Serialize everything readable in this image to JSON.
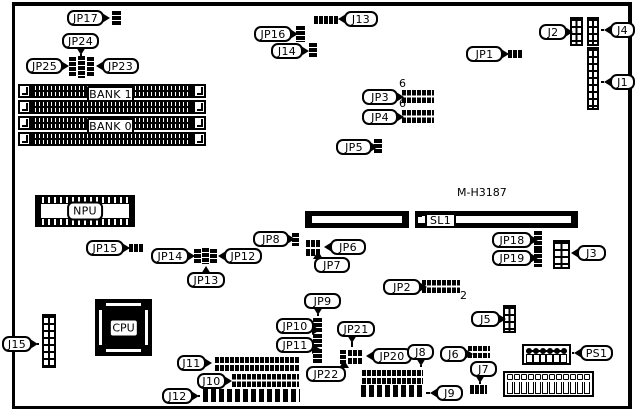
{
  "page": {
    "background": "#ffffff",
    "line_color": "#000000",
    "board_model": "M-H3187"
  },
  "components": [
    {
      "name": "board-outline",
      "type": "frame",
      "x": 12,
      "y": 2,
      "w": 620,
      "h": 407
    },
    {
      "name": "callout-jp17",
      "type": "callout",
      "label": "JP17",
      "x": 67,
      "y": 10,
      "w": 37,
      "h": 16,
      "dir": "right"
    },
    {
      "name": "jumper-jp17",
      "type": "jv",
      "x": 112,
      "y": 11,
      "w": 9,
      "h": 15
    },
    {
      "name": "callout-jp24",
      "type": "callout",
      "label": "JP24",
      "x": 62,
      "y": 33,
      "w": 37,
      "h": 16,
      "dir": "down",
      "leader": 2
    },
    {
      "name": "callout-jp25",
      "type": "callout",
      "label": "JP25",
      "x": 26,
      "y": 58,
      "w": 37,
      "h": 16,
      "dir": "right"
    },
    {
      "name": "callout-jp23",
      "type": "callout",
      "label": "JP23",
      "x": 102,
      "y": 58,
      "w": 37,
      "h": 16,
      "dir": "left"
    },
    {
      "name": "jumper-jp25",
      "type": "jv",
      "x": 69,
      "y": 57,
      "w": 7,
      "h": 20
    },
    {
      "name": "jumper-jp24",
      "type": "jv",
      "x": 78,
      "y": 56,
      "w": 7,
      "h": 22
    },
    {
      "name": "jumper-jp23",
      "type": "jv",
      "x": 87,
      "y": 57,
      "w": 7,
      "h": 20
    },
    {
      "name": "simm-clip-left-1",
      "type": "clip",
      "x": 18,
      "y": 84,
      "w": 13,
      "h": 14
    },
    {
      "name": "simm-clip-left-2",
      "type": "clip",
      "x": 18,
      "y": 100,
      "w": 13,
      "h": 14
    },
    {
      "name": "simm-clip-left-3",
      "type": "clip",
      "x": 18,
      "y": 116,
      "w": 13,
      "h": 14
    },
    {
      "name": "simm-clip-left-4",
      "type": "clip",
      "x": 18,
      "y": 132,
      "w": 13,
      "h": 14
    },
    {
      "name": "simm-socket-1",
      "type": "simm",
      "x": 31,
      "y": 84,
      "w": 162,
      "h": 14
    },
    {
      "name": "simm-socket-2",
      "type": "simm",
      "x": 31,
      "y": 100,
      "w": 162,
      "h": 14
    },
    {
      "name": "simm-socket-3",
      "type": "simm",
      "x": 31,
      "y": 116,
      "w": 162,
      "h": 14
    },
    {
      "name": "simm-socket-4",
      "type": "simm",
      "x": 31,
      "y": 132,
      "w": 162,
      "h": 14
    },
    {
      "name": "simm-clip-right-1",
      "type": "clip",
      "x": 193,
      "y": 84,
      "w": 13,
      "h": 14
    },
    {
      "name": "simm-clip-right-2",
      "type": "clip",
      "x": 193,
      "y": 100,
      "w": 13,
      "h": 14
    },
    {
      "name": "simm-clip-right-3",
      "type": "clip",
      "x": 193,
      "y": 116,
      "w": 13,
      "h": 14
    },
    {
      "name": "simm-clip-right-4",
      "type": "clip",
      "x": 193,
      "y": 132,
      "w": 13,
      "h": 14
    },
    {
      "name": "label-bank1",
      "type": "callout",
      "label": "BANK 1",
      "x": 87,
      "y": 86,
      "w": 47,
      "h": 16,
      "variant": "square"
    },
    {
      "name": "label-bank0",
      "type": "callout",
      "label": "BANK 0",
      "x": 87,
      "y": 118,
      "w": 47,
      "h": 16,
      "variant": "square"
    },
    {
      "name": "callout-jp16",
      "type": "callout",
      "label": "JP16",
      "x": 254,
      "y": 26,
      "w": 38,
      "h": 16,
      "dir": "right"
    },
    {
      "name": "jumper-jp16",
      "type": "jv",
      "x": 296,
      "y": 26,
      "w": 9,
      "h": 16
    },
    {
      "name": "callout-j13",
      "type": "callout",
      "label": "J13",
      "x": 344,
      "y": 11,
      "w": 34,
      "h": 16,
      "dir": "left"
    },
    {
      "name": "connector-j13",
      "type": "jh",
      "x": 314,
      "y": 16,
      "w": 25,
      "h": 8
    },
    {
      "name": "callout-j14",
      "type": "callout",
      "label": "J14",
      "x": 271,
      "y": 43,
      "w": 32,
      "h": 16,
      "dir": "right"
    },
    {
      "name": "jumper-j14",
      "type": "jv",
      "x": 309,
      "y": 43,
      "w": 8,
      "h": 15
    },
    {
      "name": "callout-j2",
      "type": "callout",
      "label": "J2",
      "x": 539,
      "y": 24,
      "w": 28,
      "h": 16,
      "dir": "right"
    },
    {
      "name": "connector-j2",
      "type": "grid",
      "x": 570,
      "y": 17,
      "w": 13,
      "h": 29
    },
    {
      "name": "callout-j4",
      "type": "callout",
      "label": "J4",
      "x": 610,
      "y": 22,
      "w": 25,
      "h": 16,
      "dir": "left",
      "leader": 3
    },
    {
      "name": "connector-j4",
      "type": "grid",
      "x": 587,
      "y": 17,
      "w": 12,
      "h": 29
    },
    {
      "name": "callout-j1",
      "type": "callout",
      "label": "J1",
      "x": 610,
      "y": 74,
      "w": 25,
      "h": 16,
      "dir": "left",
      "leader": 3
    },
    {
      "name": "connector-j1",
      "type": "grid",
      "x": 587,
      "y": 47,
      "w": 12,
      "h": 63
    },
    {
      "name": "callout-jp1",
      "type": "callout",
      "label": "JP1",
      "x": 466,
      "y": 46,
      "w": 37,
      "h": 16,
      "dir": "right"
    },
    {
      "name": "jumper-jp1",
      "type": "jh",
      "x": 508,
      "y": 50,
      "w": 15,
      "h": 8
    },
    {
      "name": "callout-jp3",
      "type": "callout",
      "label": "JP3",
      "x": 362,
      "y": 89,
      "w": 36,
      "h": 16,
      "dir": "right"
    },
    {
      "name": "block-jp3",
      "type": "bg",
      "x": 402,
      "y": 90,
      "w": 32,
      "h": 13
    },
    {
      "name": "pin6-jp3",
      "type": "txt",
      "label": "6",
      "x": 399,
      "y": 78,
      "w": 10,
      "h": 12
    },
    {
      "name": "callout-jp4",
      "type": "callout",
      "label": "JP4",
      "x": 362,
      "y": 109,
      "w": 36,
      "h": 16,
      "dir": "right"
    },
    {
      "name": "block-jp4",
      "type": "bg",
      "x": 402,
      "y": 110,
      "w": 32,
      "h": 13
    },
    {
      "name": "pin6-jp4",
      "type": "txt",
      "label": "6",
      "x": 399,
      "y": 98,
      "w": 10,
      "h": 12
    },
    {
      "name": "callout-jp5",
      "type": "callout",
      "label": "JP5",
      "x": 336,
      "y": 139,
      "w": 36,
      "h": 16,
      "dir": "right"
    },
    {
      "name": "jumper-jp5",
      "type": "jv",
      "x": 374,
      "y": 139,
      "w": 8,
      "h": 15
    },
    {
      "name": "npu-socket",
      "type": "npu",
      "label": "NPU",
      "x": 35,
      "y": 195,
      "w": 100,
      "h": 32
    },
    {
      "name": "board-model-text",
      "type": "txt",
      "label": "M-H3187",
      "x": 457,
      "y": 187,
      "w": 62,
      "h": 13
    },
    {
      "name": "slot-a",
      "type": "slot",
      "x": 305,
      "y": 211,
      "w": 104,
      "h": 17
    },
    {
      "name": "slot-b",
      "type": "slot",
      "x": 415,
      "y": 211,
      "w": 163,
      "h": 17
    },
    {
      "name": "sl1-pin",
      "type": "sq",
      "x": 418,
      "y": 217,
      "w": 6,
      "h": 6
    },
    {
      "name": "label-sl1",
      "type": "callout",
      "label": "SL1",
      "x": 425,
      "y": 213,
      "w": 31,
      "h": 15,
      "variant": "square"
    },
    {
      "name": "callout-jp15",
      "type": "callout",
      "label": "JP15",
      "x": 86,
      "y": 240,
      "w": 38,
      "h": 16,
      "dir": "right"
    },
    {
      "name": "jumper-jp15",
      "type": "jh",
      "x": 129,
      "y": 244,
      "w": 14,
      "h": 8
    },
    {
      "name": "callout-jp14",
      "type": "callout",
      "label": "JP14",
      "x": 151,
      "y": 248,
      "w": 38,
      "h": 16,
      "dir": "right"
    },
    {
      "name": "callout-jp12",
      "type": "callout",
      "label": "JP12",
      "x": 224,
      "y": 248,
      "w": 38,
      "h": 16,
      "dir": "left"
    },
    {
      "name": "callout-jp13",
      "type": "callout",
      "label": "JP13",
      "x": 187,
      "y": 272,
      "w": 38,
      "h": 16,
      "dir": "up"
    },
    {
      "name": "jumper-jp14",
      "type": "jv",
      "x": 194,
      "y": 249,
      "w": 7,
      "h": 14
    },
    {
      "name": "jumper-jp13",
      "type": "jv",
      "x": 202,
      "y": 248,
      "w": 7,
      "h": 16
    },
    {
      "name": "jumper-jp12",
      "type": "jv",
      "x": 210,
      "y": 249,
      "w": 7,
      "h": 14
    },
    {
      "name": "callout-jp8",
      "type": "callout",
      "label": "JP8",
      "x": 253,
      "y": 231,
      "w": 36,
      "h": 16,
      "dir": "right"
    },
    {
      "name": "jumper-jp8",
      "type": "jv",
      "x": 292,
      "y": 233,
      "w": 7,
      "h": 13
    },
    {
      "name": "callout-jp6",
      "type": "callout",
      "label": "JP6",
      "x": 330,
      "y": 239,
      "w": 36,
      "h": 16,
      "dir": "left"
    },
    {
      "name": "block-jp6-jp7",
      "type": "bg",
      "x": 306,
      "y": 240,
      "w": 14,
      "h": 16
    },
    {
      "name": "callout-jp7",
      "type": "callout",
      "label": "JP7",
      "x": 314,
      "y": 257,
      "w": 36,
      "h": 16,
      "dir": "up",
      "shift": -14
    },
    {
      "name": "callout-jp18",
      "type": "callout",
      "label": "JP18",
      "x": 492,
      "y": 232,
      "w": 40,
      "h": 16,
      "dir": "right"
    },
    {
      "name": "jumper-jp18",
      "type": "jv",
      "x": 534,
      "y": 231,
      "w": 8,
      "h": 18
    },
    {
      "name": "callout-jp19",
      "type": "callout",
      "label": "JP19",
      "x": 492,
      "y": 250,
      "w": 40,
      "h": 16,
      "dir": "right"
    },
    {
      "name": "jumper-jp19",
      "type": "jv",
      "x": 534,
      "y": 249,
      "w": 8,
      "h": 18
    },
    {
      "name": "callout-j3",
      "type": "callout",
      "label": "J3",
      "x": 577,
      "y": 245,
      "w": 29,
      "h": 16,
      "dir": "left"
    },
    {
      "name": "connector-j3",
      "type": "grid",
      "x": 553,
      "y": 240,
      "w": 17,
      "h": 29
    },
    {
      "name": "callout-jp2",
      "type": "callout",
      "label": "JP2",
      "x": 383,
      "y": 279,
      "w": 38,
      "h": 16,
      "dir": "right"
    },
    {
      "name": "block-jp2",
      "type": "bg",
      "x": 422,
      "y": 280,
      "w": 38,
      "h": 13
    },
    {
      "name": "pin2-jp2",
      "type": "txt",
      "label": "2",
      "x": 460,
      "y": 290,
      "w": 10,
      "h": 12
    },
    {
      "name": "callout-j5",
      "type": "callout",
      "label": "J5",
      "x": 471,
      "y": 311,
      "w": 29,
      "h": 16,
      "dir": "right"
    },
    {
      "name": "connector-j5",
      "type": "grid",
      "x": 503,
      "y": 305,
      "w": 13,
      "h": 28
    },
    {
      "name": "callout-jp9",
      "type": "callout",
      "label": "JP9",
      "x": 304,
      "y": 293,
      "w": 37,
      "h": 16,
      "dir": "down",
      "shift": -5,
      "leader": 2
    },
    {
      "name": "jumper-jp9",
      "type": "jv",
      "x": 313,
      "y": 318,
      "w": 9,
      "h": 14
    },
    {
      "name": "callout-jp10",
      "type": "callout",
      "label": "JP10",
      "x": 276,
      "y": 318,
      "w": 38,
      "h": 16,
      "dir": "right",
      "shift": 4
    },
    {
      "name": "jumper-jp10",
      "type": "jv",
      "x": 313,
      "y": 334,
      "w": 9,
      "h": 13
    },
    {
      "name": "callout-jp11",
      "type": "callout",
      "label": "JP11",
      "x": 276,
      "y": 337,
      "w": 38,
      "h": 16,
      "dir": "right",
      "shift": 4
    },
    {
      "name": "jumper-jp11",
      "type": "jv",
      "x": 313,
      "y": 349,
      "w": 9,
      "h": 14
    },
    {
      "name": "callout-jp21",
      "type": "callout",
      "label": "JP21",
      "x": 337,
      "y": 321,
      "w": 38,
      "h": 16,
      "dir": "down",
      "shift": -4,
      "leader": 5
    },
    {
      "name": "jumper-jp22",
      "type": "jv",
      "x": 340,
      "y": 350,
      "w": 6,
      "h": 14
    },
    {
      "name": "block-jp21",
      "type": "bg",
      "x": 348,
      "y": 350,
      "w": 15,
      "h": 14
    },
    {
      "name": "callout-jp22",
      "type": "callout",
      "label": "JP22",
      "x": 306,
      "y": 366,
      "w": 40,
      "h": 16,
      "dir": "up",
      "shift": 18
    },
    {
      "name": "callout-jp20",
      "type": "callout",
      "label": "JP20",
      "x": 372,
      "y": 348,
      "w": 40,
      "h": 16,
      "dir": "left"
    },
    {
      "name": "callout-j8",
      "type": "callout",
      "label": "J8",
      "x": 407,
      "y": 344,
      "w": 27,
      "h": 16,
      "dir": "down",
      "leader": 2
    },
    {
      "name": "connector-j8",
      "type": "bg",
      "x": 362,
      "y": 370,
      "w": 61,
      "h": 14
    },
    {
      "name": "callout-j9",
      "type": "callout",
      "label": "J9",
      "x": 436,
      "y": 385,
      "w": 27,
      "h": 16,
      "dir": "left",
      "leader": 4
    },
    {
      "name": "connector-j9",
      "type": "bars",
      "x": 361,
      "y": 385,
      "w": 62,
      "h": 12
    },
    {
      "name": "callout-j6",
      "type": "callout",
      "label": "J6",
      "x": 440,
      "y": 346,
      "w": 27,
      "h": 16,
      "dir": "right"
    },
    {
      "name": "block-j6",
      "type": "bg",
      "x": 468,
      "y": 346,
      "w": 22,
      "h": 12
    },
    {
      "name": "callout-j7",
      "type": "callout",
      "label": "J7",
      "x": 470,
      "y": 361,
      "w": 27,
      "h": 16,
      "dir": "down",
      "shift": -4,
      "leader": 2
    },
    {
      "name": "jumper-j7",
      "type": "jh",
      "x": 470,
      "y": 385,
      "w": 17,
      "h": 9
    },
    {
      "name": "callout-j15",
      "type": "callout",
      "label": "J15",
      "x": 2,
      "y": 336,
      "w": 30,
      "h": 16,
      "dir": "right",
      "leader": 2
    },
    {
      "name": "connector-j15",
      "type": "grid",
      "x": 42,
      "y": 314,
      "w": 14,
      "h": 54
    },
    {
      "name": "cpu-socket",
      "type": "cpu",
      "label": "CPU",
      "x": 95,
      "y": 299,
      "w": 57,
      "h": 57
    },
    {
      "name": "callout-j11",
      "type": "callout",
      "label": "J11",
      "x": 177,
      "y": 355,
      "w": 29,
      "h": 16,
      "dir": "right"
    },
    {
      "name": "connector-j11",
      "type": "bg",
      "x": 215,
      "y": 357,
      "w": 85,
      "h": 14
    },
    {
      "name": "callout-j10",
      "type": "callout",
      "label": "J10",
      "x": 197,
      "y": 373,
      "w": 29,
      "h": 16,
      "dir": "right"
    },
    {
      "name": "connector-j10",
      "type": "bg",
      "x": 232,
      "y": 374,
      "w": 67,
      "h": 13
    },
    {
      "name": "callout-j12",
      "type": "callout",
      "label": "J12",
      "x": 162,
      "y": 388,
      "w": 31,
      "h": 16,
      "dir": "right",
      "leader": 2
    },
    {
      "name": "connector-j12",
      "type": "bars",
      "x": 203,
      "y": 389,
      "w": 97,
      "h": 13
    },
    {
      "name": "connector-ps1",
      "type": "psconn",
      "x": 522,
      "y": 344,
      "w": 49,
      "h": 21
    },
    {
      "name": "callout-ps1",
      "type": "callout",
      "label": "PS1",
      "x": 580,
      "y": 345,
      "w": 33,
      "h": 16,
      "dir": "left",
      "leader": 2
    },
    {
      "name": "connector-power-strip",
      "type": "psstrip",
      "x": 503,
      "y": 371,
      "w": 91,
      "h": 26
    }
  ]
}
